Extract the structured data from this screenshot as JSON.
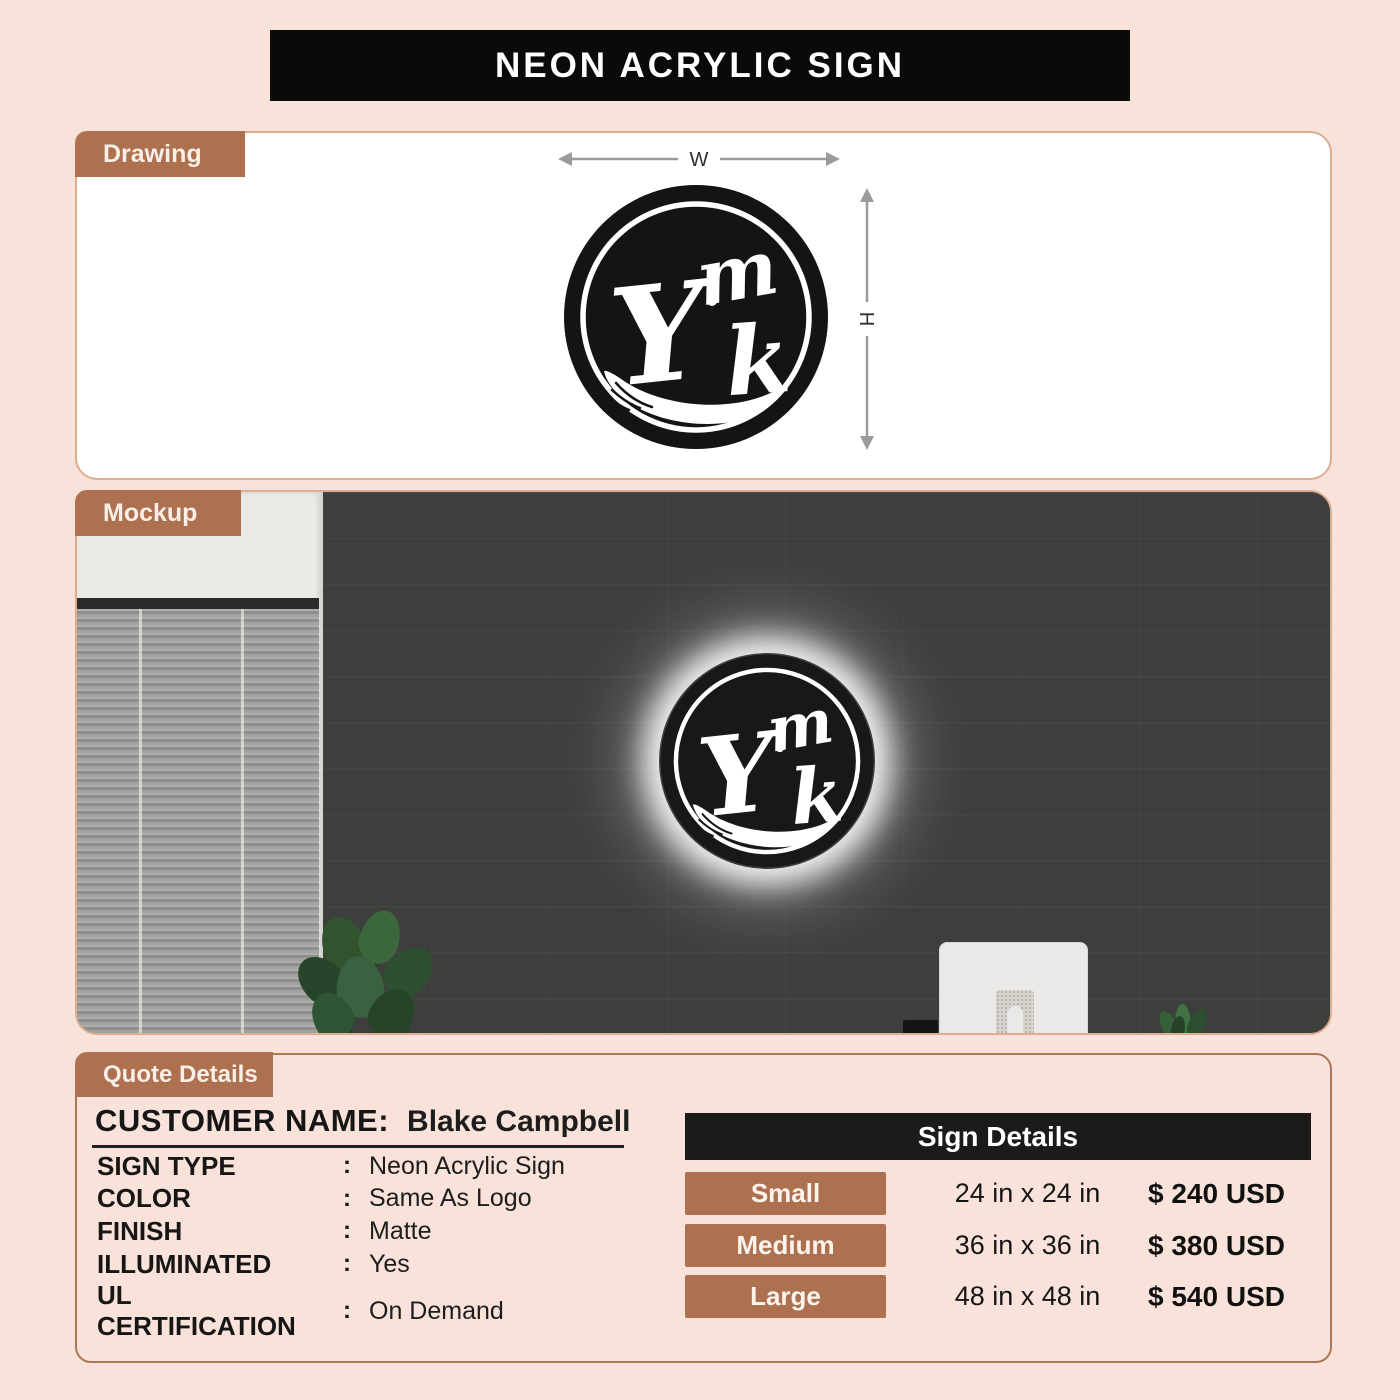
{
  "header": {
    "title": "NEON ACRYLIC SIGN"
  },
  "drawing": {
    "tab_label": "Drawing",
    "width_label": "W",
    "height_label": "H"
  },
  "logo": {
    "letter_top": "m",
    "letter_main": "Y",
    "letter_bottom": "k"
  },
  "mockup": {
    "tab_label": "Mockup"
  },
  "quote": {
    "tab_label": "Quote Details",
    "customer_name_label": "CUSTOMER NAME:",
    "customer_name_value": "Blake Campbell",
    "fields": [
      {
        "label": "SIGN TYPE",
        "sep": ":",
        "value": "Neon Acrylic Sign"
      },
      {
        "label": "COLOR",
        "sep": ":",
        "value": "Same As Logo"
      },
      {
        "label": "FINISH",
        "sep": ":",
        "value": "Matte"
      },
      {
        "label": "ILLUMINATED",
        "sep": ":",
        "value": "Yes"
      },
      {
        "label": "UL CERTIFICATION",
        "sep": ":",
        "value": "On Demand"
      }
    ]
  },
  "sign_details": {
    "title": "Sign Details",
    "rows": [
      {
        "size": "Small",
        "dimensions": "24 in x 24 in",
        "price": "$ 240 USD"
      },
      {
        "size": "Medium",
        "dimensions": "36 in x 36 in",
        "price": "$ 380 USD"
      },
      {
        "size": "Large",
        "dimensions": "48 in x 48 in",
        "price": "$ 540 USD"
      }
    ]
  },
  "colors": {
    "background_peach": "#f8e2d9",
    "accent_brown": "#ad7150",
    "header_black": "#0a0a09",
    "table_header_black": "#1c1b19",
    "panel_border_tan": "#dcae91"
  }
}
